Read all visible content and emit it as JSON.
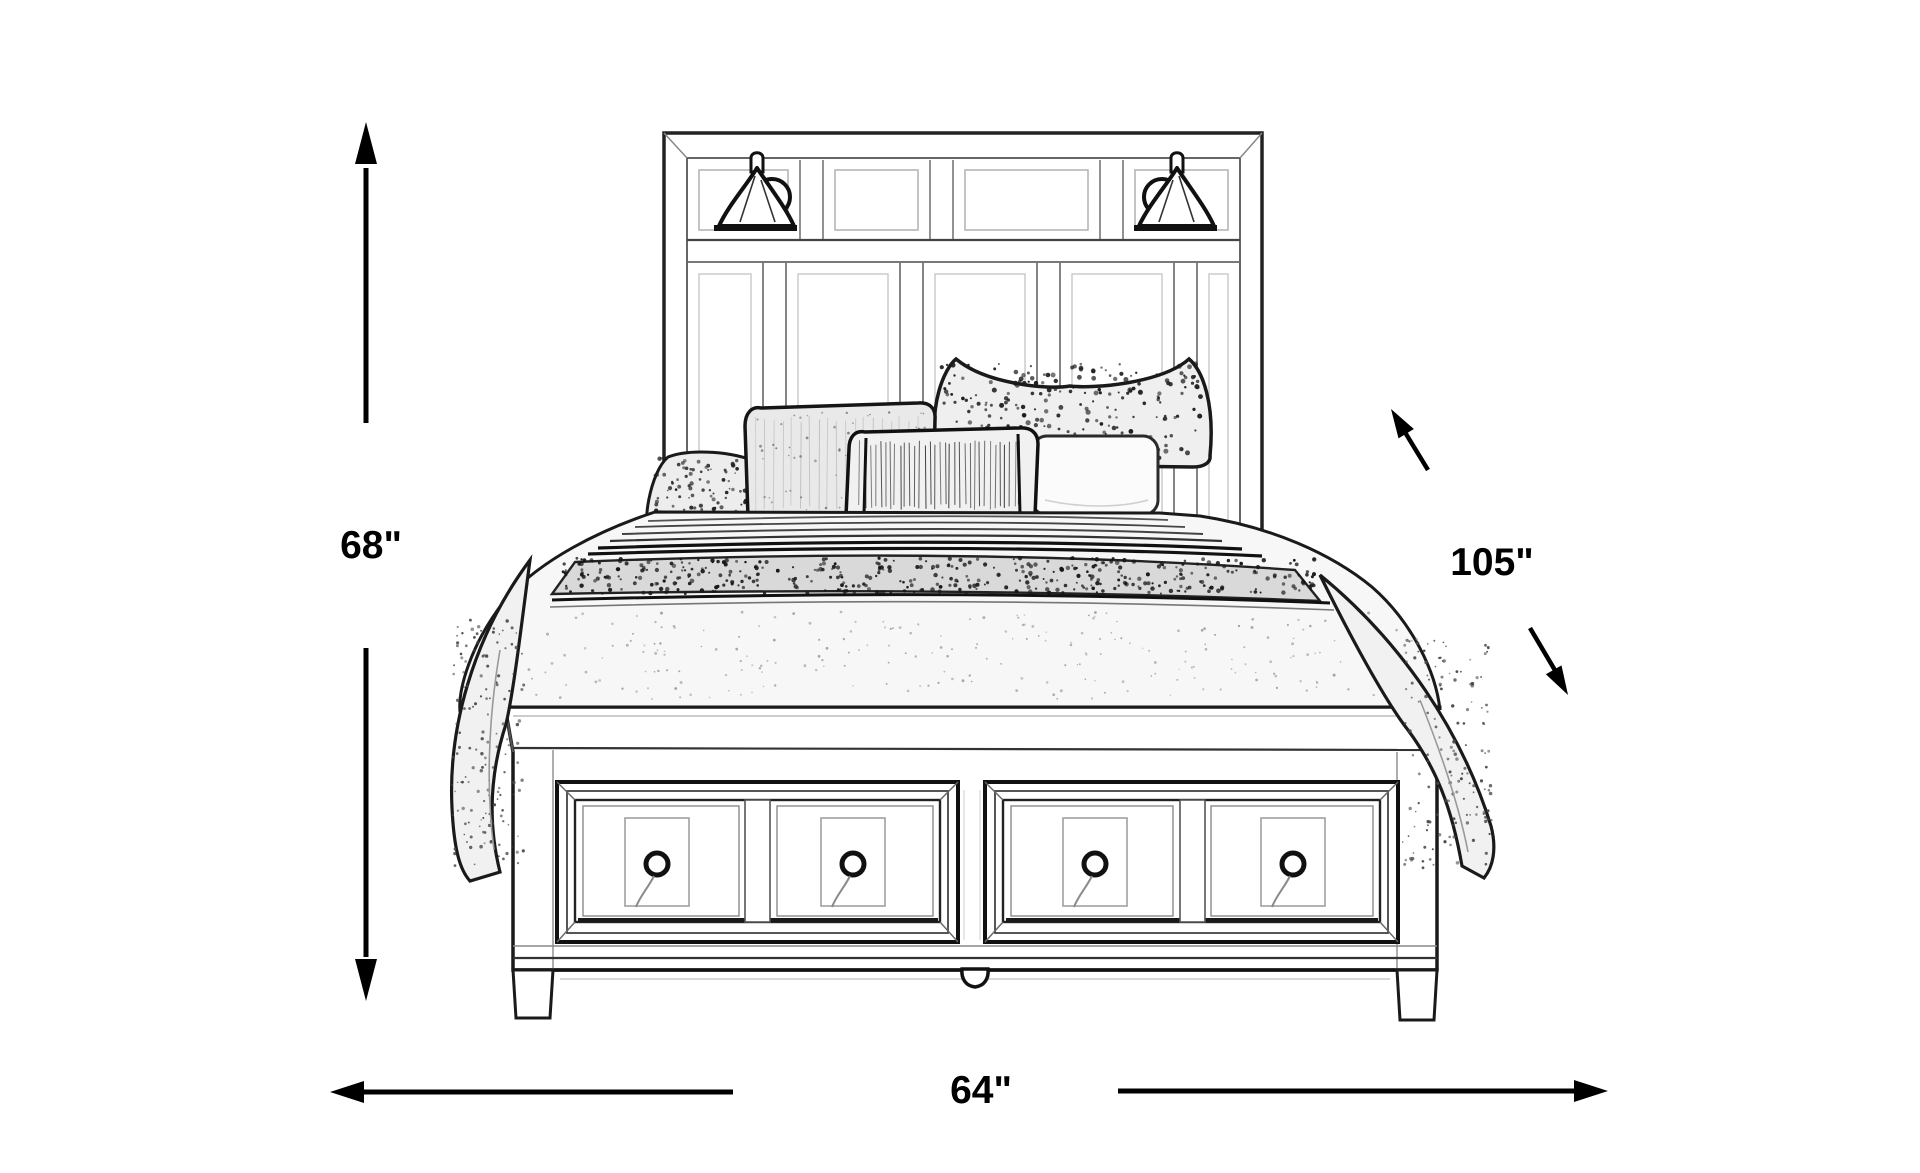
{
  "page": {
    "background": "#ffffff"
  },
  "diagram": {
    "type": "furniture-dimension-sketch",
    "subject": "storage bed line drawing with paneled headboard, two sconce lamps, pillows, draped quilt and a two-drawer storage footboard",
    "dimensions": {
      "height": {
        "value": 68,
        "unit": "in",
        "label": "68\""
      },
      "depth": {
        "value": 105,
        "unit": "in",
        "label": "105\""
      },
      "width": {
        "value": 64,
        "unit": "in",
        "label": "64\""
      }
    },
    "colors": {
      "line": "#1a1a1a",
      "background": "#ffffff",
      "pillow_shade": "#ededed",
      "band_shade": "#d9d9d9"
    },
    "parts": [
      "paneled headboard",
      "left sconce lamp",
      "right sconce lamp",
      "textured euro sham",
      "accent pillows",
      "striped lumbar pillow",
      "quilted bedspread with patterned band",
      "storage footboard with four drawer fronts",
      "round drawer knobs",
      "tapered legs"
    ]
  }
}
